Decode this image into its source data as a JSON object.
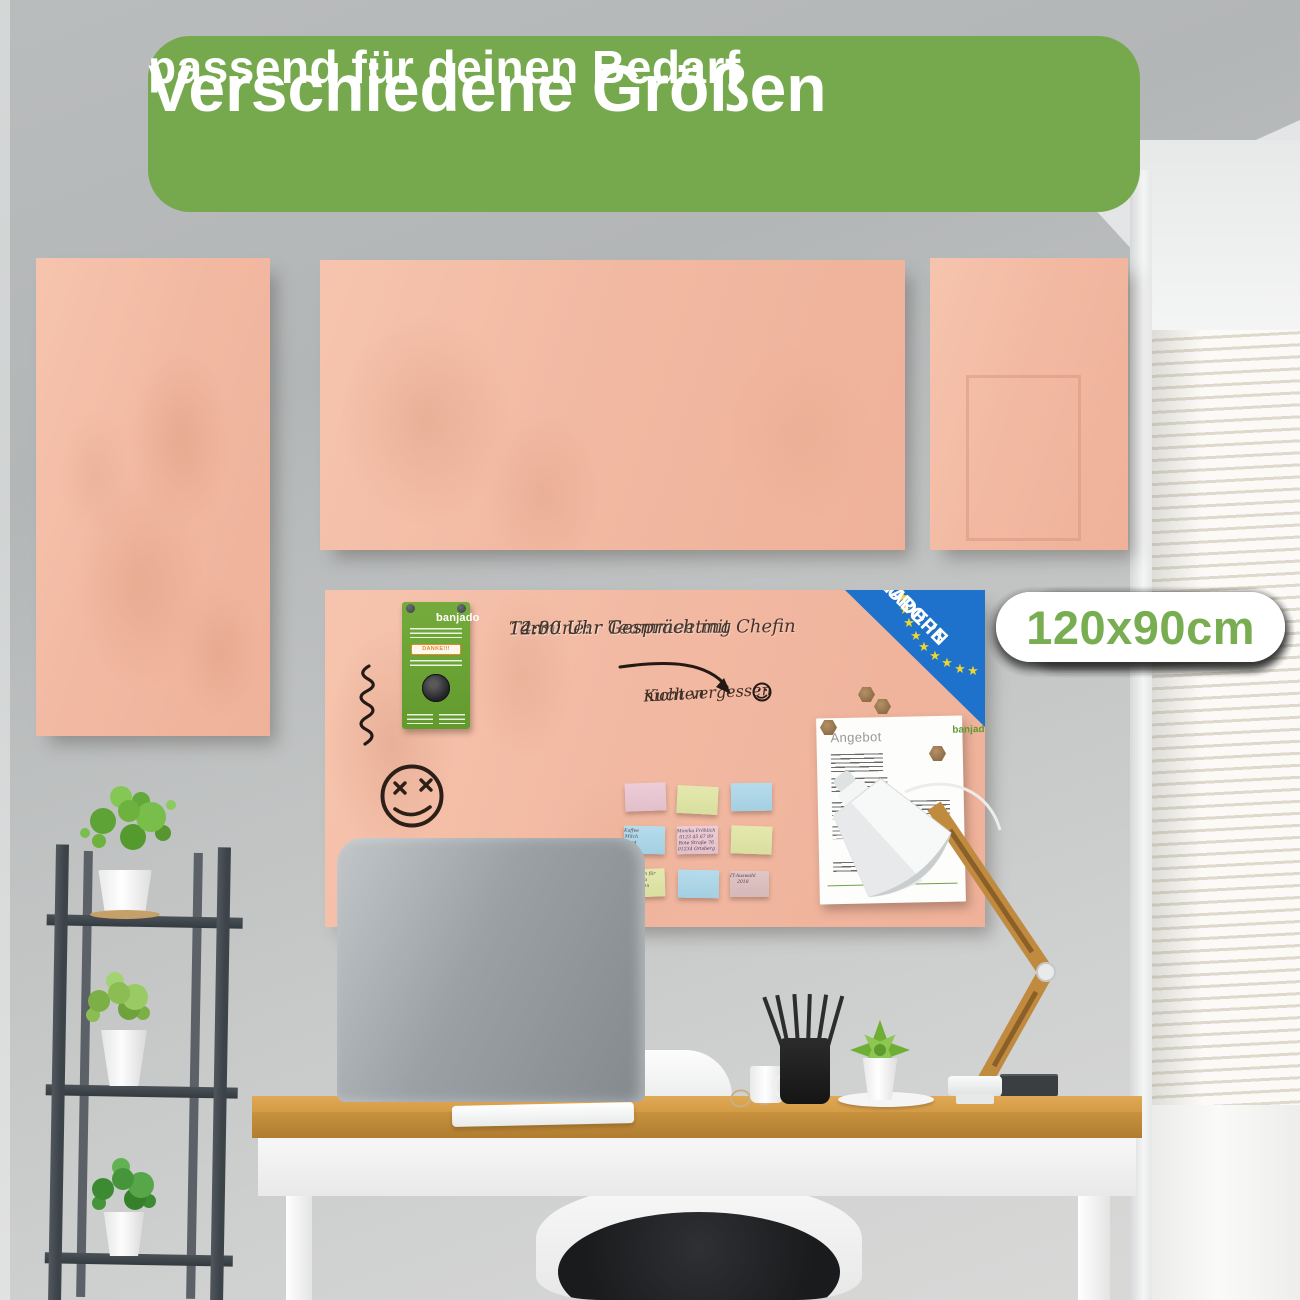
{
  "banner": {
    "title": "Verschiedene Größen",
    "subtitle": "passend für deinen Bedarf"
  },
  "sizes": [
    "45x30cm",
    "60x40cm",
    "75x50cm",
    "90x60cm",
    "100x50cm",
    "100x70cm",
    "120x60cm",
    "120x80cm",
    "120x90cm"
  ],
  "board": {
    "handwriting": {
      "heading": "Termine:",
      "line1": "12:30 Uhr Teammeeting",
      "line2": "14:00 Uhr Gespräch mit Chefin",
      "reminder_line1": "Kuchen",
      "reminder_line2": "nicht vergessen"
    },
    "label": {
      "brand": "banjado",
      "danke": "DANKE!!!"
    },
    "made_in": {
      "line1": "MADE IN",
      "line2": "EUROPE"
    },
    "document": {
      "title": "Angebot",
      "brand": "banjado"
    },
    "sticky_notes": [
      {
        "color": "rose",
        "text": ""
      },
      {
        "color": "lime",
        "text": ""
      },
      {
        "color": "blue",
        "text": ""
      },
      {
        "color": "blue",
        "text": "Kaffee\nMilch\nBrot"
      },
      {
        "color": "rose",
        "text": "Monika Fröhlich\n0123 45 67 89\nRote Straße 76\n01234 Ortsberg"
      },
      {
        "color": "lime",
        "text": ""
      },
      {
        "color": "lime",
        "text": "Gutschein für\nMama\nabholen"
      },
      {
        "color": "blue",
        "text": ""
      },
      {
        "color": "mauve",
        "text": "IT-Auswahl\n2018"
      }
    ]
  },
  "colors": {
    "banner_green": "#76a94e",
    "badge_text_green": "#78ad52",
    "board_pink": "#f2b9a2",
    "europe_blue": "#1e72cb",
    "star_yellow": "#eed62f",
    "label_green": "#6ca334"
  }
}
